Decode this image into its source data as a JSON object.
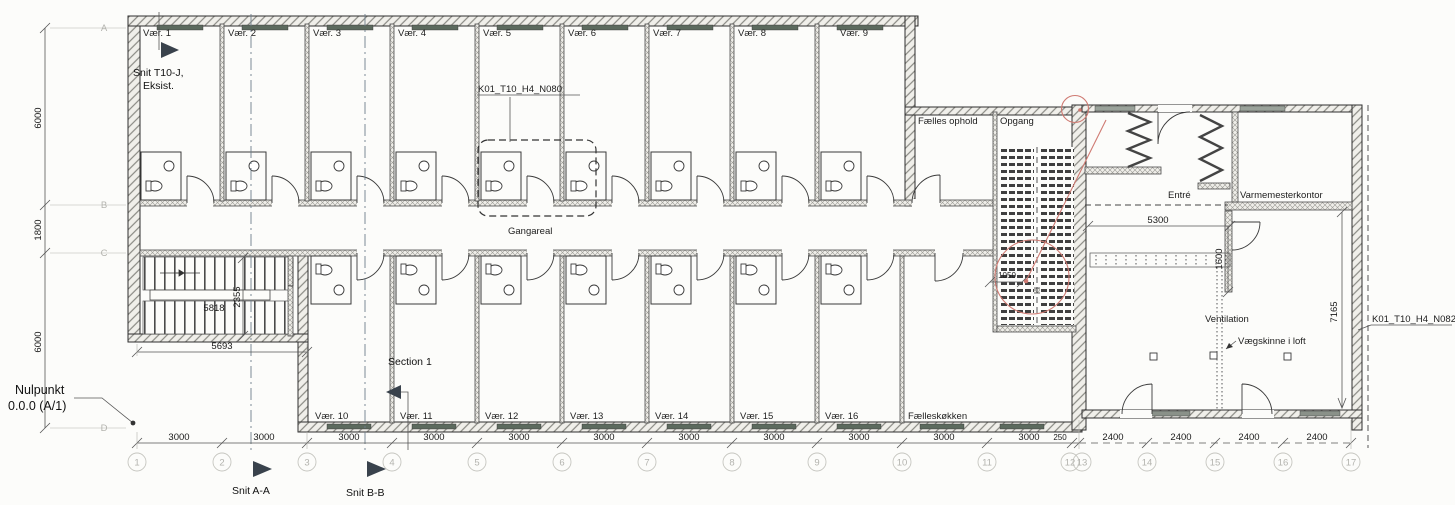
{
  "drawing": {
    "rooms": {
      "top": [
        "Vær. 1",
        "Vær. 2",
        "Vær. 3",
        "Vær. 4",
        "Vær. 5",
        "Vær. 6",
        "Vær. 7",
        "Vær. 8",
        "Vær. 9"
      ],
      "bottom": [
        "Vær. 10",
        "Vær. 11",
        "Vær. 12",
        "Vær. 13",
        "Vær. 14",
        "Vær. 15",
        "Vær. 16"
      ],
      "kitchen": "Fælleskøkken",
      "common": "Fælles ophold",
      "stair_hall": "Opgang",
      "corridor": "Gangareal",
      "entry": "Entré",
      "office": "Varmemesterkontor"
    },
    "ann": {
      "snit_t10_line1": "Snit T10-J,",
      "snit_t10_line2": "Eksist.",
      "n080": "K01_T10_H4_N080",
      "n082": "K01_T10_H4_N082",
      "nulpunkt_line1": "Nulpunkt",
      "nulpunkt_line2": "0.0.0 (A/1)",
      "snit_aa": "Snit A-A",
      "snit_bb": "Snit B-B",
      "section1": "Section 1",
      "ventilation": "Ventilation",
      "vaegskinne": "Vægskinne i loft"
    },
    "dims": {
      "left": [
        "6000",
        "1800",
        "6000"
      ],
      "b3000": [
        "3000",
        "3000",
        "3000",
        "3000",
        "3000",
        "3000",
        "3000",
        "3000",
        "3000",
        "3000",
        "3000"
      ],
      "b250": "250",
      "b2400": [
        "2400",
        "2400",
        "2400",
        "2400"
      ],
      "stair_v": "2355",
      "stair_inner": "5818",
      "stair_bottom": "5693",
      "wing_entry": "5300",
      "wing_1600": "1600",
      "niche_1050": "1050",
      "wing_7165": "7165"
    },
    "grid": {
      "cols": [
        "1",
        "2",
        "3",
        "4",
        "5",
        "6",
        "7",
        "8",
        "9",
        "10",
        "11",
        "12",
        "13",
        "14",
        "15",
        "16",
        "17"
      ],
      "rows": [
        "A",
        "B",
        "C",
        "D"
      ]
    },
    "colors": {
      "paper": "#fcfcfa",
      "ink": "#2e2e2e",
      "faint_grid": "#b3b3ae",
      "window_fill": "#5c6a5e",
      "markup_red": "#cf7a72",
      "section_arrow": "#39424c",
      "wall_hatch": "#8a8a84"
    }
  }
}
